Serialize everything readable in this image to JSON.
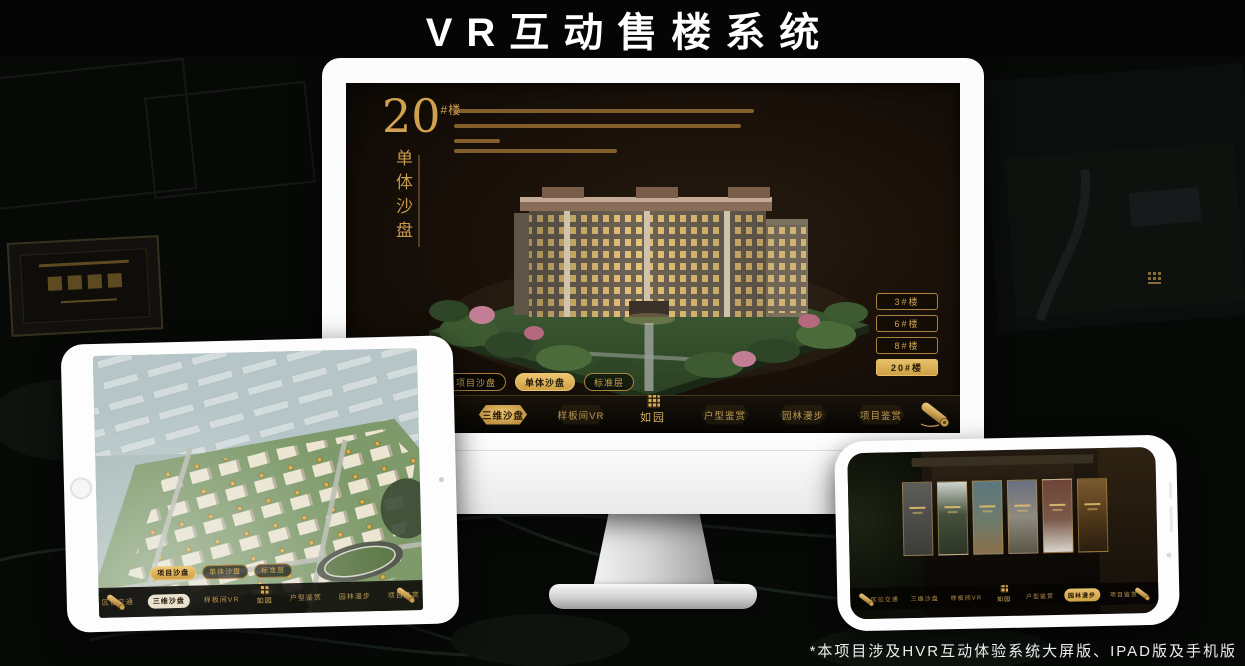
{
  "page": {
    "title": "VR互动售楼系统",
    "footnote": "*本项目涉及HVR互动体验系统大屏版、IPAD版及手机版"
  },
  "colors": {
    "gold_accent": "#d2a855",
    "gold_deep": "#a9843d",
    "screen_background": "#17100a",
    "selected_text": "#241806"
  },
  "monitor_app": {
    "unit_title": {
      "number": "20",
      "suffix": "#楼",
      "subtitle": "单体沙盘"
    },
    "building_buttons": [
      {
        "label": "3#楼"
      },
      {
        "label": "6#楼"
      },
      {
        "label": "8#楼"
      },
      {
        "label": "20#楼",
        "selected": true
      }
    ],
    "view_tabs": [
      {
        "label": "项目沙盘"
      },
      {
        "label": "单体沙盘",
        "selected": true
      },
      {
        "label": "标准层"
      }
    ],
    "nav": {
      "items": [
        {
          "label": "区位交通"
        },
        {
          "label": "三维沙盘",
          "selected": true
        },
        {
          "label": "样板间VR"
        },
        {
          "label": "户型鉴赏"
        },
        {
          "label": "园林漫步"
        },
        {
          "label": "项目鉴赏"
        }
      ],
      "logo": "如园",
      "scroll_icon": "scroll-icon"
    }
  },
  "tablet_app": {
    "view_tabs": [
      {
        "label": "项目沙盘",
        "selected": true
      },
      {
        "label": "单体沙盘"
      },
      {
        "label": "标准层"
      }
    ],
    "nav": {
      "items": [
        {
          "label": "区位交通"
        },
        {
          "label": "三维沙盘",
          "selected": true
        },
        {
          "label": "样板间VR"
        },
        {
          "label": "户型鉴赏"
        },
        {
          "label": "园林漫步"
        },
        {
          "label": "项目鉴赏"
        }
      ],
      "logo": "如园"
    }
  },
  "phone_app": {
    "nav": {
      "items": [
        {
          "label": "区位交通"
        },
        {
          "label": "三维沙盘"
        },
        {
          "label": "样板间VR"
        },
        {
          "label": "户型鉴赏"
        },
        {
          "label": "园林漫步",
          "selected": true
        },
        {
          "label": "项目鉴赏"
        }
      ],
      "logo": "如园",
      "gallery_panel_count": 6
    }
  }
}
